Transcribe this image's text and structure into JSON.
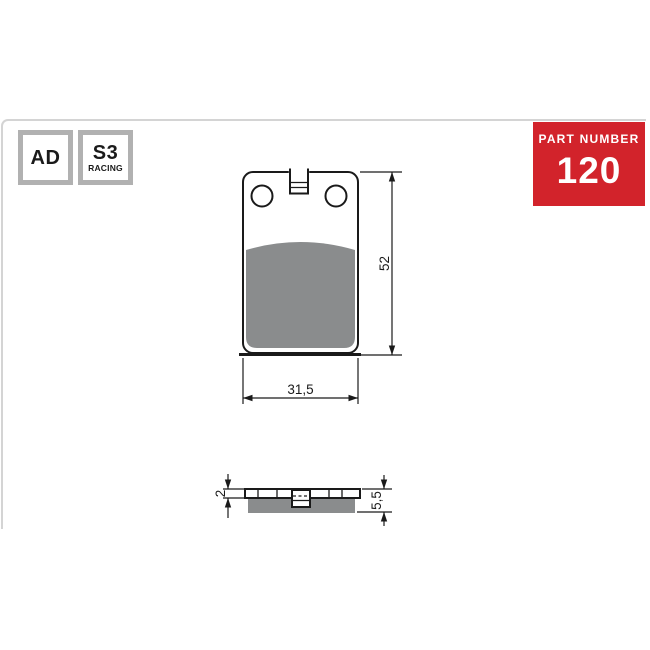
{
  "badges": {
    "compound": {
      "label": "AD"
    },
    "racing": {
      "label": "S3",
      "sublabel": "RACING"
    }
  },
  "part_number": {
    "label": "PART NUMBER",
    "value": "120"
  },
  "diagram": {
    "type": "technical-drawing",
    "subject": "brake-pad",
    "front_view": {
      "height_dim": "52",
      "width_dim": "31,5"
    },
    "side_view": {
      "backplate_thickness_dim": "2",
      "total_thickness_dim": "5,5"
    }
  },
  "colors": {
    "accent_red": "#d2232b",
    "friction_gray": "#8a8c8d",
    "badge_border": "#b1b1b1",
    "frame_border": "#d4d4d4",
    "line_black": "#1a1a1a"
  }
}
